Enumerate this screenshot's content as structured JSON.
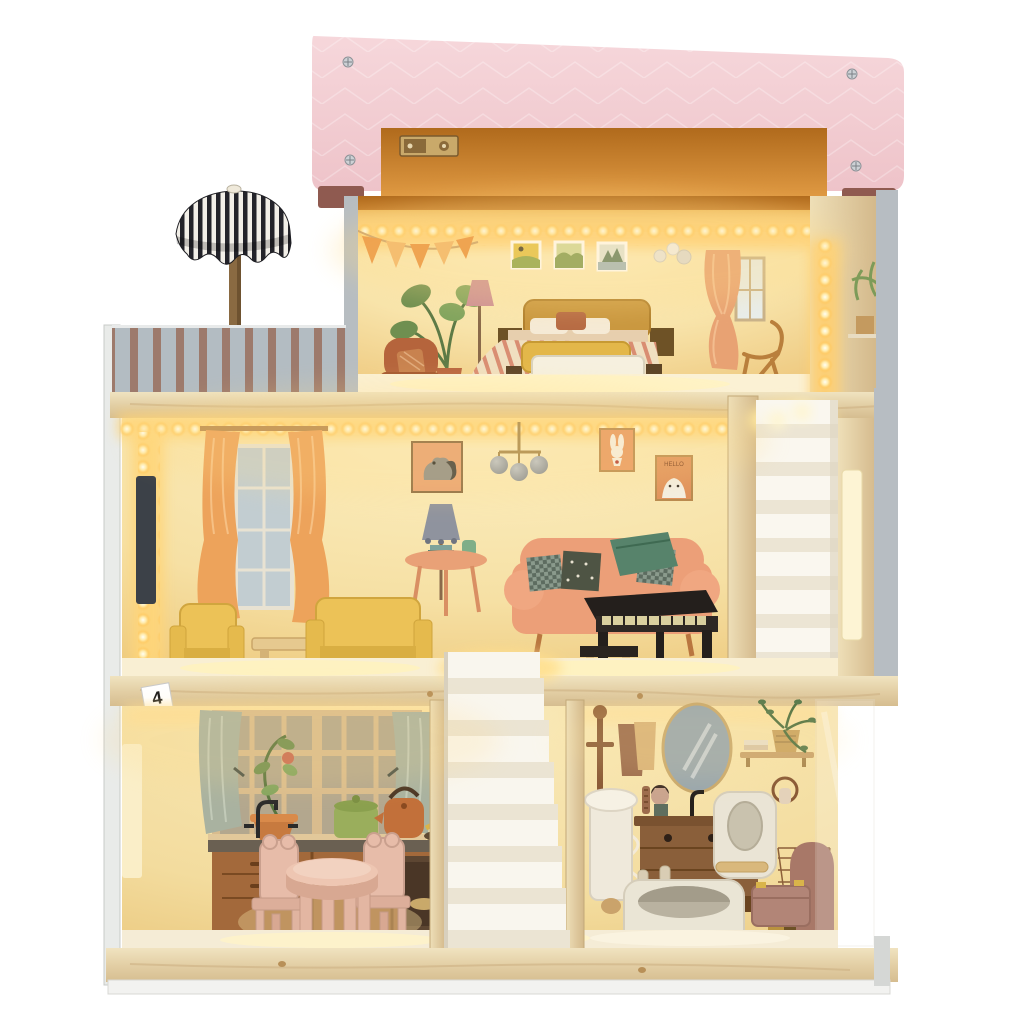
{
  "image": {
    "type": "product photograph",
    "description": "Three-story wooden dollhouse with warm LED fairy lights, pink roof, striped parasol balcony, attic bedroom, living room with piano and sofas, kitchen with pink dining set, bathroom with tub and toilet, and two white staircases",
    "background": "white"
  },
  "labels": {
    "part_sticker": "4",
    "poster_caption": "HELLO"
  },
  "palette": {
    "roof_pink": "#f3ced4",
    "roof_edge_maroon": "#8f5a50",
    "roof_underside_orange": "#c8812e",
    "wood_pine": "#e4d0a6",
    "led_glow": "#ffd97c",
    "led_core": "#fffbe8",
    "wall_warm": "#f7e5b2",
    "stripe_gray": "#b3bcc2",
    "stripe_mauve": "#9d7a6c",
    "parasol_black": "#23232a",
    "furniture_yellow": "#ecc257",
    "furniture_pink": "#e7bca9",
    "sofa_salmon": "#ec9f78",
    "piano_black": "#262019",
    "toilet_mauve": "#a87868",
    "stair_white": "#f8f5ec",
    "curtain_orange": "#eda35b",
    "kitchen_sage": "#a9b2a0"
  },
  "rooms": {
    "roof": {
      "items": [
        "pink-roof-panel",
        "screws",
        "hinge",
        "orange-underside"
      ]
    },
    "balcony": {
      "items": [
        "striped-parasol",
        "striped-railing-wall"
      ]
    },
    "attic_bedroom": {
      "items": [
        "led-string",
        "bunting-flags",
        "wall-pictures",
        "printed-bed",
        "floor-lamp",
        "monstera-plant",
        "armchair",
        "curtain-window",
        "rocking-chair",
        "wooden-toy-bed"
      ]
    },
    "living_room": {
      "items": [
        "tv",
        "curtain-window",
        "dog-picture",
        "chandelier",
        "rabbit-picture",
        "bear-picture",
        "floor-lamp",
        "side-table",
        "printed-sofa",
        "yellow-armchair",
        "coffee-table",
        "yellow-sofa",
        "piano",
        "piano-bench",
        "white-staircase"
      ]
    },
    "kitchen": {
      "items": [
        "window",
        "sage-curtains",
        "potted-flower",
        "green-pot",
        "copper-kettle",
        "fruit-bowl",
        "counter-with-oven",
        "black-faucet",
        "pink-dining-table",
        "pink-chairs",
        "rug"
      ]
    },
    "bathroom": {
      "items": [
        "coat-stand",
        "towels",
        "oval-mirror",
        "shelf-with-plant",
        "towel-ring",
        "vanity",
        "pedestal-sink",
        "washing-machine",
        "bathtub",
        "toilet",
        "laundry-basket"
      ]
    },
    "stairs": {
      "items": [
        "center-white-staircase",
        "right-white-staircase"
      ]
    }
  }
}
